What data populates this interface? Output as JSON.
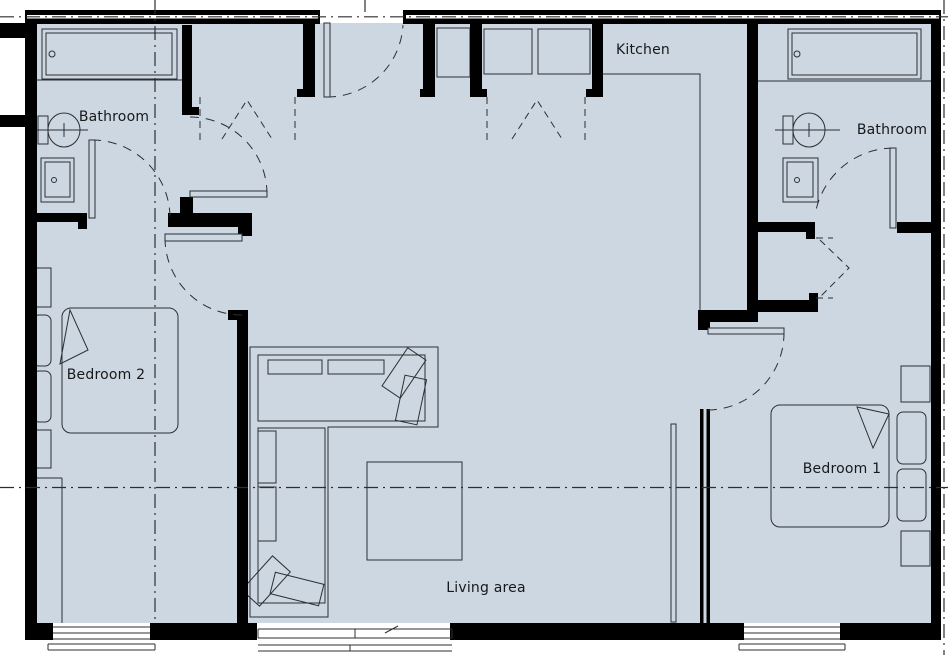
{
  "plan": {
    "title": "apartment-floor-plan",
    "rooms": {
      "kitchen": {
        "label": "Kitchen"
      },
      "bathroom_left": {
        "label": "Bathroom"
      },
      "bathroom_right": {
        "label": "Bathroom"
      },
      "bedroom_2": {
        "label": "Bedroom 2"
      },
      "bedroom_1": {
        "label": "Bedroom 1"
      },
      "living_area": {
        "label": "Living area"
      }
    },
    "colors": {
      "floor": "#cdd7e1",
      "wall": "#000000",
      "line": "#2b2f33",
      "text": "#17181a",
      "bg": "#ffffff"
    }
  }
}
